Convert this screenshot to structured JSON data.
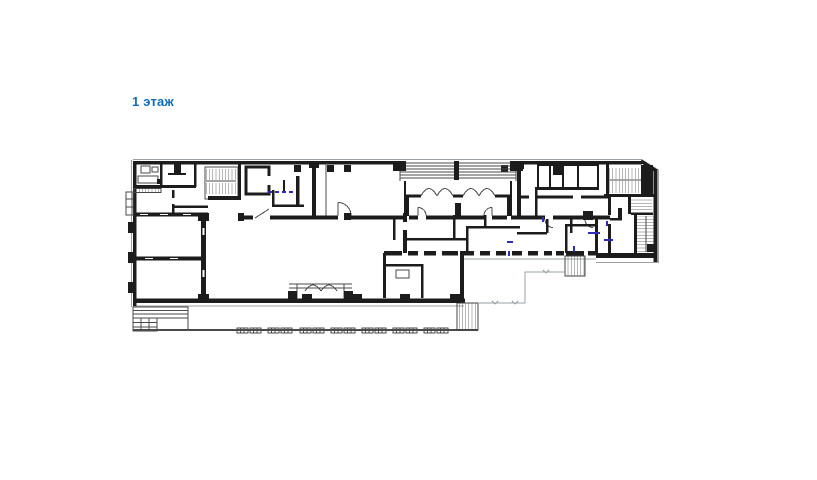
{
  "window": {
    "background": "#ffffff"
  },
  "label": {
    "text": "1 этаж",
    "color": "#0f6cb5"
  },
  "plan": {
    "line_color": "#1c1c1c",
    "thin_line_color": "#4a4a4a",
    "light_line_color": "#9aa0a6",
    "blue_mark_color": "#2d2db8",
    "features": [
      "main-entrance-portico",
      "entrance-vestibule",
      "northwest-stairwell",
      "elevator-shaft",
      "east-double-stairwell",
      "east-long-stair",
      "south-mid-stair",
      "south-terrace-with-steps",
      "pavement-markers",
      "corridor-pier-wall",
      "service-cell-row"
    ]
  }
}
